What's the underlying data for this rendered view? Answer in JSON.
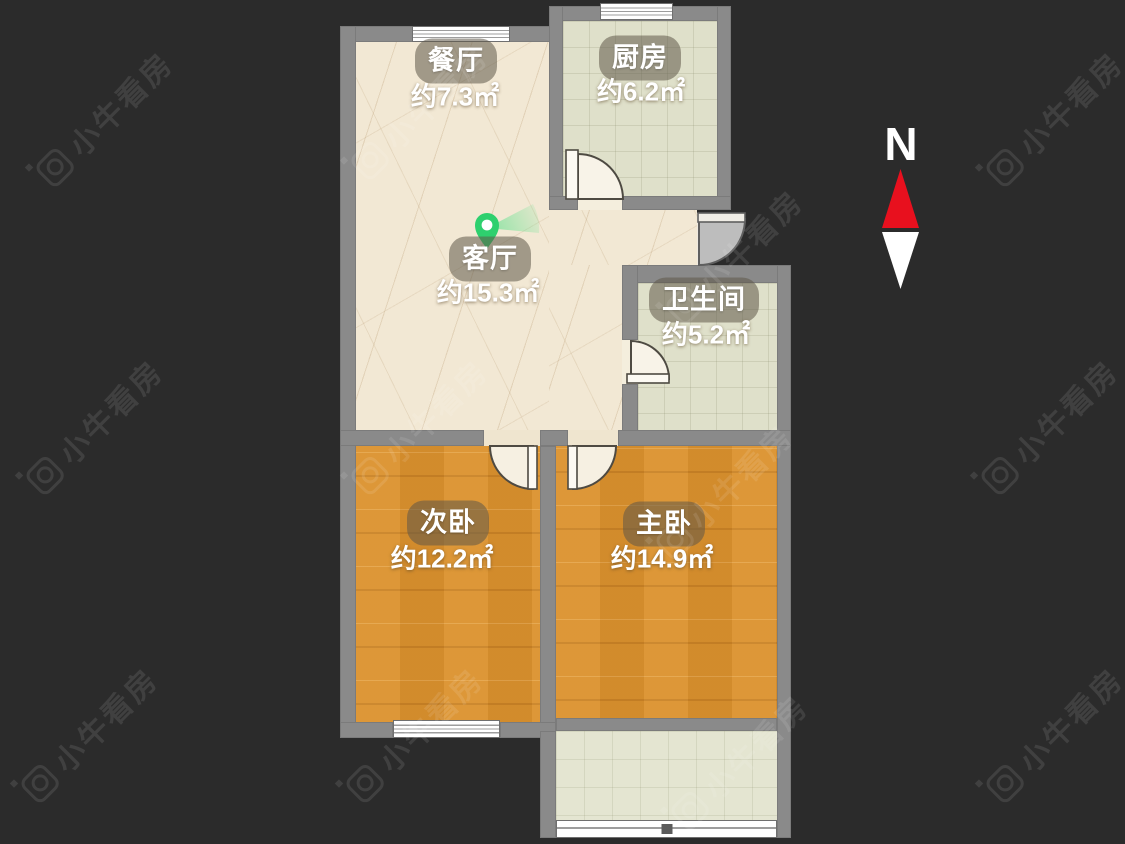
{
  "watermark": {
    "text": "小牛看房"
  },
  "compass": {
    "label": "N"
  },
  "rooms": {
    "dining": {
      "name": "餐厅",
      "area": "约7.3㎡"
    },
    "kitchen": {
      "name": "厨房",
      "area": "约6.2㎡"
    },
    "living": {
      "name": "客厅",
      "area": "约15.3㎡"
    },
    "bathroom": {
      "name": "卫生间",
      "area": "约5.2㎡"
    },
    "second_bedroom": {
      "name": "次卧",
      "area": "约12.2㎡"
    },
    "master_bedroom": {
      "name": "主卧",
      "area": "约14.9㎡"
    }
  },
  "colors": {
    "background": "#2b2b2b",
    "wall": "#8a8a8a",
    "floor_beige": "#f2e8d4",
    "floor_tile": "#dfe0ca",
    "floor_wood": "#d9912f",
    "north_red": "#e8101e",
    "pin_green": "#2ed06e"
  }
}
